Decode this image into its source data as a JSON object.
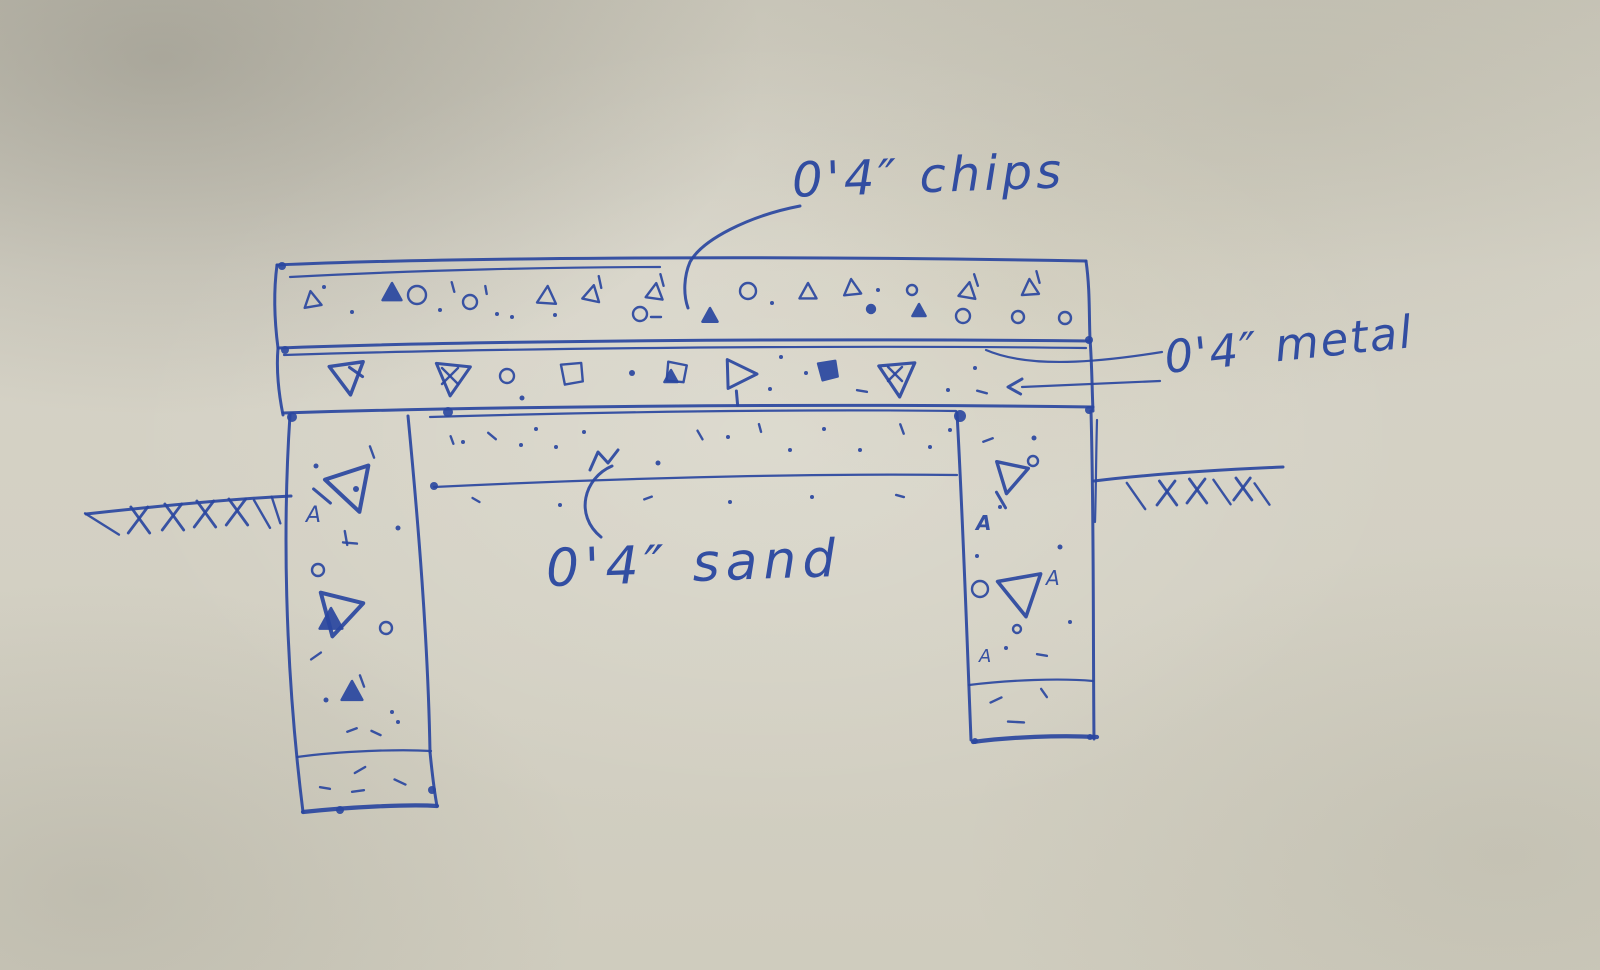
{
  "sketch": {
    "description": "hand-drawn pen sketch of a foundation / slab cross-section on textured paper",
    "ink_color": "#2a47a0",
    "paper_color": "#d2cfc3",
    "labels": {
      "chips": "0'4″ chips",
      "metal": "0'4″ metal",
      "sand": "0'4″ sand"
    },
    "layers": [
      {
        "name": "chips layer",
        "thickness": "0'4″",
        "texture": "small triangles, circles, dots"
      },
      {
        "name": "metal layer",
        "thickness": "0'4″",
        "texture": "large triangles, squares, diamonds"
      },
      {
        "name": "sand layer",
        "thickness": "0'4″",
        "texture": "fine dots"
      },
      {
        "name": "left column with footing",
        "texture": "aggregate triangles, circles, dots"
      },
      {
        "name": "right column with footing",
        "texture": "aggregate triangles, circles, dots"
      },
      {
        "name": "ground line with hatching",
        "texture": "cross hatches left and right"
      }
    ],
    "symbols": {
      "chips": [
        {
          "t": "tu",
          "x": 312,
          "y": 300,
          "s": 9,
          "r": -10
        },
        {
          "t": "d",
          "x": 324,
          "y": 287,
          "s": 2
        },
        {
          "t": "d",
          "x": 352,
          "y": 312,
          "s": 2
        },
        {
          "t": "tf",
          "x": 392,
          "y": 293,
          "s": 10
        },
        {
          "t": "c",
          "x": 417,
          "y": 295,
          "s": 9
        },
        {
          "t": "d",
          "x": 440,
          "y": 310,
          "s": 2
        },
        {
          "t": "ln",
          "x": 453,
          "y": 287,
          "s": 5,
          "r": 75
        },
        {
          "t": "c",
          "x": 470,
          "y": 302,
          "s": 7
        },
        {
          "t": "ln",
          "x": 486,
          "y": 290,
          "s": 4,
          "r": 80
        },
        {
          "t": "d",
          "x": 497,
          "y": 314,
          "s": 2
        },
        {
          "t": "d",
          "x": 512,
          "y": 317,
          "s": 2
        },
        {
          "t": "tu",
          "x": 547,
          "y": 296,
          "s": 10,
          "r": 4
        },
        {
          "t": "d",
          "x": 555,
          "y": 315,
          "s": 2
        },
        {
          "t": "tu",
          "x": 592,
          "y": 294,
          "s": 9,
          "r": 12
        },
        {
          "t": "ln",
          "x": 600,
          "y": 282,
          "s": 6,
          "r": 78
        },
        {
          "t": "c",
          "x": 640,
          "y": 314,
          "s": 7
        },
        {
          "t": "ln",
          "x": 656,
          "y": 317,
          "s": 5,
          "r": 0
        },
        {
          "t": "tu",
          "x": 655,
          "y": 292,
          "s": 9,
          "r": 8
        },
        {
          "t": "ln",
          "x": 662,
          "y": 280,
          "s": 6,
          "r": 75
        },
        {
          "t": "tf",
          "x": 710,
          "y": 316,
          "s": 8
        },
        {
          "t": "c",
          "x": 748,
          "y": 291,
          "s": 8
        },
        {
          "t": "d",
          "x": 772,
          "y": 303,
          "s": 2
        },
        {
          "t": "tu",
          "x": 808,
          "y": 292,
          "s": 9
        },
        {
          "t": "tu",
          "x": 852,
          "y": 288,
          "s": 9,
          "r": -6
        },
        {
          "t": "d",
          "x": 878,
          "y": 290,
          "s": 2
        },
        {
          "t": "c",
          "x": 871,
          "y": 309,
          "s": 4,
          "f": 1
        },
        {
          "t": "c",
          "x": 912,
          "y": 290,
          "s": 5
        },
        {
          "t": "tf",
          "x": 919,
          "y": 311,
          "s": 7
        },
        {
          "t": "tu",
          "x": 968,
          "y": 291,
          "s": 9,
          "r": 10
        },
        {
          "t": "ln",
          "x": 976,
          "y": 280,
          "s": 6,
          "r": 72
        },
        {
          "t": "c",
          "x": 963,
          "y": 316,
          "s": 7
        },
        {
          "t": "tu",
          "x": 1030,
          "y": 288,
          "s": 9,
          "r": -4
        },
        {
          "t": "ln",
          "x": 1038,
          "y": 277,
          "s": 6,
          "r": 75
        },
        {
          "t": "c",
          "x": 1018,
          "y": 317,
          "s": 6
        },
        {
          "t": "c",
          "x": 1065,
          "y": 318,
          "s": 6
        }
      ],
      "metal": [
        {
          "t": "td",
          "x": 348,
          "y": 377,
          "s": 18,
          "r": -8,
          "w": 3.5
        },
        {
          "t": "ln",
          "x": 356,
          "y": 372,
          "s": 8,
          "r": 35,
          "w": 3
        },
        {
          "t": "td",
          "x": 452,
          "y": 378,
          "s": 18,
          "r": 6,
          "w": 3
        },
        {
          "t": "x",
          "x": 450,
          "y": 376,
          "s": 8
        },
        {
          "t": "c",
          "x": 507,
          "y": 376,
          "s": 7
        },
        {
          "t": "d",
          "x": 522,
          "y": 398,
          "s": 2.5
        },
        {
          "t": "q",
          "x": 572,
          "y": 373,
          "s": 14,
          "r": -8
        },
        {
          "t": "d",
          "x": 632,
          "y": 373,
          "s": 3
        },
        {
          "t": "q",
          "x": 676,
          "y": 372,
          "s": 13,
          "r": 8
        },
        {
          "t": "tf",
          "x": 671,
          "y": 377,
          "s": 7
        },
        {
          "t": "tr",
          "x": 740,
          "y": 374,
          "s": 17,
          "w": 3
        },
        {
          "t": "ln",
          "x": 737,
          "y": 398,
          "s": 7,
          "r": 85,
          "w": 3
        },
        {
          "t": "d",
          "x": 781,
          "y": 357,
          "s": 2
        },
        {
          "t": "d",
          "x": 770,
          "y": 389,
          "s": 2
        },
        {
          "t": "qf",
          "x": 828,
          "y": 370,
          "s": 12,
          "r": -12
        },
        {
          "t": "d",
          "x": 806,
          "y": 373,
          "s": 2
        },
        {
          "t": "ln",
          "x": 862,
          "y": 391,
          "s": 5,
          "r": 10
        },
        {
          "t": "td",
          "x": 898,
          "y": 378,
          "s": 19,
          "r": -5,
          "w": 3.2
        },
        {
          "t": "x",
          "x": 895,
          "y": 374,
          "s": 7
        },
        {
          "t": "d",
          "x": 948,
          "y": 390,
          "s": 2
        },
        {
          "t": "d",
          "x": 975,
          "y": 368,
          "s": 2
        },
        {
          "t": "ln",
          "x": 982,
          "y": 392,
          "s": 5,
          "r": 15
        },
        {
          "t": "ah",
          "x": 1008,
          "y": 387,
          "s": 14
        }
      ],
      "left_column": [
        {
          "t": "ln",
          "x": 372,
          "y": 452,
          "s": 6,
          "r": 70
        },
        {
          "t": "d",
          "x": 316,
          "y": 466,
          "s": 2.5
        },
        {
          "t": "td",
          "x": 352,
          "y": 489,
          "s": 24,
          "r": -18,
          "w": 4
        },
        {
          "t": "d",
          "x": 356,
          "y": 489,
          "s": 3
        },
        {
          "t": "ln",
          "x": 322,
          "y": 496,
          "s": 11,
          "r": 40,
          "w": 3
        },
        {
          "t": "A",
          "x": 306,
          "y": 522,
          "s": 22
        },
        {
          "t": "d",
          "x": 398,
          "y": 528,
          "s": 2.5
        },
        {
          "t": "ln",
          "x": 350,
          "y": 543,
          "s": 7,
          "r": 5
        },
        {
          "t": "ln",
          "x": 346,
          "y": 538,
          "s": 7,
          "r": 80
        },
        {
          "t": "c",
          "x": 318,
          "y": 570,
          "s": 6
        },
        {
          "t": "td",
          "x": 338,
          "y": 614,
          "s": 23,
          "r": 14,
          "w": 4
        },
        {
          "t": "tf",
          "x": 331,
          "y": 620,
          "s": 12
        },
        {
          "t": "c",
          "x": 386,
          "y": 628,
          "s": 6
        },
        {
          "t": "ln",
          "x": 316,
          "y": 656,
          "s": 6,
          "r": -35
        },
        {
          "t": "tf",
          "x": 352,
          "y": 692,
          "s": 11
        },
        {
          "t": "ln",
          "x": 362,
          "y": 681,
          "s": 6,
          "r": 70
        },
        {
          "t": "d",
          "x": 326,
          "y": 700,
          "s": 2.5
        },
        {
          "t": "d",
          "x": 392,
          "y": 712,
          "s": 2
        },
        {
          "t": "ln",
          "x": 352,
          "y": 730,
          "s": 5,
          "r": -20
        },
        {
          "t": "ln",
          "x": 376,
          "y": 733,
          "s": 5,
          "r": 25
        },
        {
          "t": "d",
          "x": 398,
          "y": 722,
          "s": 2
        },
        {
          "t": "ln",
          "x": 360,
          "y": 770,
          "s": 6,
          "r": -30
        },
        {
          "t": "ln",
          "x": 400,
          "y": 782,
          "s": 6,
          "r": 25
        },
        {
          "t": "ln",
          "x": 325,
          "y": 788,
          "s": 5,
          "r": 10
        },
        {
          "t": "ln",
          "x": 358,
          "y": 791,
          "s": 6,
          "r": -8
        }
      ],
      "right_column": [
        {
          "t": "ln",
          "x": 988,
          "y": 440,
          "s": 5,
          "r": -20
        },
        {
          "t": "d",
          "x": 1034,
          "y": 438,
          "s": 2.5
        },
        {
          "t": "td",
          "x": 1010,
          "y": 477,
          "s": 17,
          "r": 12,
          "w": 3.4
        },
        {
          "t": "c",
          "x": 1033,
          "y": 461,
          "s": 5
        },
        {
          "t": "ln",
          "x": 1001,
          "y": 500,
          "s": 9,
          "r": 60,
          "w": 3
        },
        {
          "t": "A",
          "x": 976,
          "y": 530,
          "s": 20,
          "b": 1
        },
        {
          "t": "d",
          "x": 1000,
          "y": 507,
          "s": 2
        },
        {
          "t": "d",
          "x": 1060,
          "y": 547,
          "s": 2.5
        },
        {
          "t": "d",
          "x": 977,
          "y": 556,
          "s": 2
        },
        {
          "t": "c",
          "x": 980,
          "y": 589,
          "s": 8
        },
        {
          "t": "td",
          "x": 1022,
          "y": 594,
          "s": 23,
          "r": -10,
          "w": 3.6
        },
        {
          "t": "A",
          "x": 1046,
          "y": 585,
          "s": 20
        },
        {
          "t": "c",
          "x": 1017,
          "y": 629,
          "s": 4
        },
        {
          "t": "A",
          "x": 979,
          "y": 662,
          "s": 18
        },
        {
          "t": "d",
          "x": 1070,
          "y": 622,
          "s": 2
        },
        {
          "t": "ln",
          "x": 1042,
          "y": 655,
          "s": 5,
          "r": 10
        },
        {
          "t": "d",
          "x": 1006,
          "y": 648,
          "s": 2
        },
        {
          "t": "ln",
          "x": 996,
          "y": 700,
          "s": 6,
          "r": -25
        },
        {
          "t": "ln",
          "x": 1044,
          "y": 693,
          "s": 5,
          "r": 55
        },
        {
          "t": "ln",
          "x": 1016,
          "y": 722,
          "s": 8,
          "r": 3
        }
      ],
      "sand": [
        {
          "t": "ln",
          "x": 452,
          "y": 440,
          "s": 4,
          "r": 70
        },
        {
          "t": "ln",
          "x": 492,
          "y": 436,
          "s": 5,
          "r": 40
        },
        {
          "t": "d",
          "x": 463,
          "y": 442,
          "s": 2
        },
        {
          "t": "d",
          "x": 521,
          "y": 445,
          "s": 2
        },
        {
          "t": "d",
          "x": 536,
          "y": 429,
          "s": 2
        },
        {
          "t": "d",
          "x": 556,
          "y": 447,
          "s": 2
        },
        {
          "t": "d",
          "x": 584,
          "y": 432,
          "s": 2
        },
        {
          "t": "d",
          "x": 658,
          "y": 463,
          "s": 2.5
        },
        {
          "t": "ln",
          "x": 700,
          "y": 435,
          "s": 5,
          "r": 60
        },
        {
          "t": "d",
          "x": 728,
          "y": 437,
          "s": 2
        },
        {
          "t": "ln",
          "x": 760,
          "y": 428,
          "s": 4,
          "r": 75
        },
        {
          "t": "d",
          "x": 790,
          "y": 450,
          "s": 2
        },
        {
          "t": "d",
          "x": 824,
          "y": 429,
          "s": 2
        },
        {
          "t": "d",
          "x": 860,
          "y": 450,
          "s": 2
        },
        {
          "t": "ln",
          "x": 902,
          "y": 429,
          "s": 5,
          "r": 70
        },
        {
          "t": "d",
          "x": 930,
          "y": 447,
          "s": 2
        },
        {
          "t": "d",
          "x": 950,
          "y": 430,
          "s": 2
        },
        {
          "t": "ln",
          "x": 476,
          "y": 500,
          "s": 4,
          "r": 30
        },
        {
          "t": "d",
          "x": 560,
          "y": 505,
          "s": 2
        },
        {
          "t": "ln",
          "x": 648,
          "y": 498,
          "s": 4,
          "r": -20
        },
        {
          "t": "d",
          "x": 730,
          "y": 502,
          "s": 2
        },
        {
          "t": "d",
          "x": 812,
          "y": 497,
          "s": 2
        },
        {
          "t": "ln",
          "x": 900,
          "y": 496,
          "s": 4,
          "r": 15
        }
      ],
      "ground_left": [
        {
          "t": "ln",
          "x": 102,
          "y": 524,
          "s": 20,
          "r": 32
        },
        {
          "t": "hx",
          "x": 138,
          "y": 520,
          "s": 13
        },
        {
          "t": "hx",
          "x": 172,
          "y": 517,
          "s": 13
        },
        {
          "t": "hx",
          "x": 204,
          "y": 514,
          "s": 13
        },
        {
          "t": "hx",
          "x": 236,
          "y": 512,
          "s": 13
        },
        {
          "t": "ln",
          "x": 262,
          "y": 514,
          "s": 16,
          "r": 60
        },
        {
          "t": "ln",
          "x": 276,
          "y": 510,
          "s": 14,
          "r": 72
        }
      ],
      "ground_right": [
        {
          "t": "ln",
          "x": 1136,
          "y": 496,
          "s": 16,
          "r": 55
        },
        {
          "t": "hx",
          "x": 1166,
          "y": 493,
          "s": 12
        },
        {
          "t": "hx",
          "x": 1196,
          "y": 491,
          "s": 12
        },
        {
          "t": "ln",
          "x": 1222,
          "y": 492,
          "s": 15,
          "r": 55
        },
        {
          "t": "hx",
          "x": 1242,
          "y": 489,
          "s": 11
        },
        {
          "t": "ln",
          "x": 1262,
          "y": 494,
          "s": 13,
          "r": 55
        }
      ],
      "blobs": [
        {
          "x": 292,
          "y": 417,
          "s": 5
        },
        {
          "x": 960,
          "y": 416,
          "s": 6
        },
        {
          "x": 1089,
          "y": 410,
          "s": 4
        },
        {
          "x": 434,
          "y": 486,
          "s": 4
        },
        {
          "x": 285,
          "y": 350,
          "s": 4
        },
        {
          "x": 1089,
          "y": 340,
          "s": 4
        },
        {
          "x": 448,
          "y": 412,
          "s": 5
        },
        {
          "x": 432,
          "y": 790,
          "s": 4
        },
        {
          "x": 340,
          "y": 810,
          "s": 4
        },
        {
          "x": 1090,
          "y": 737,
          "s": 3
        },
        {
          "x": 975,
          "y": 741,
          "s": 3
        },
        {
          "x": 282,
          "y": 266,
          "s": 4
        }
      ]
    }
  }
}
